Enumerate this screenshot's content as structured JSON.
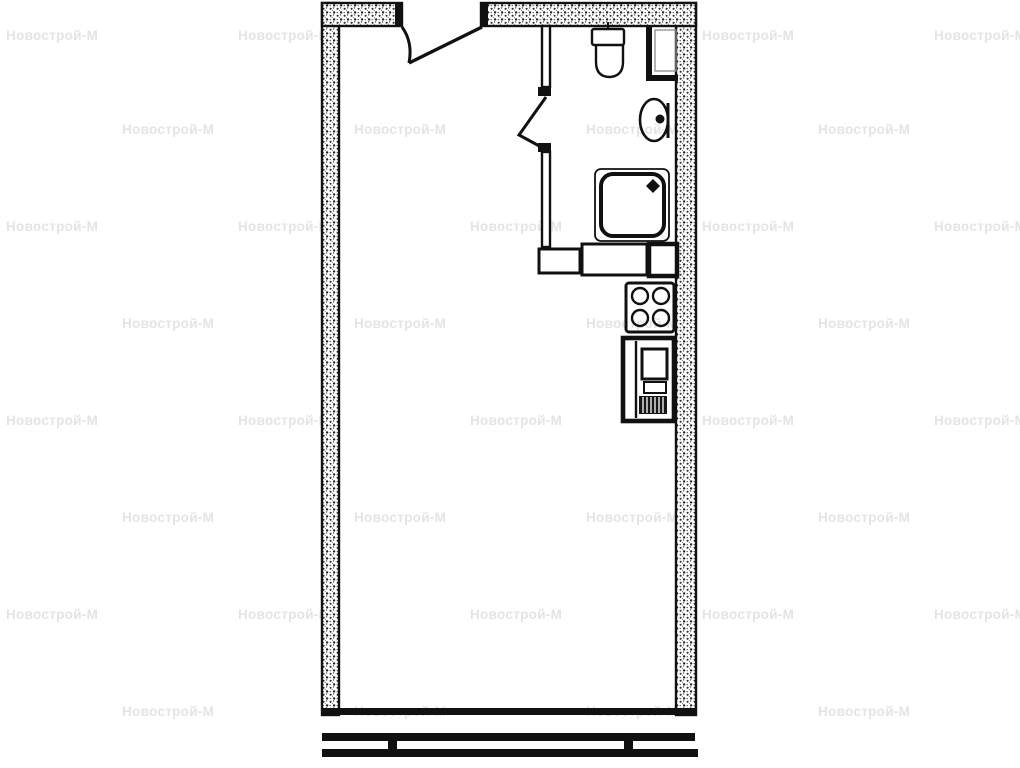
{
  "watermark": {
    "text": "Новострой-М",
    "color": "#e4e4e4"
  },
  "plan": {
    "kind": "studio-apartment-floor-plan",
    "background": "#ffffff",
    "colors": {
      "ink": "#111111",
      "wall_speckle": "#2b2b2b",
      "fill": "#ffffff"
    },
    "rooms": [
      {
        "name": "main-room"
      },
      {
        "name": "bathroom"
      },
      {
        "name": "kitchen-niche"
      }
    ],
    "fixtures": [
      {
        "name": "entrance-door",
        "type": "door-swing"
      },
      {
        "name": "bathroom-door",
        "type": "door-swing"
      },
      {
        "name": "toilet",
        "type": "wc-with-tank"
      },
      {
        "name": "washbasin",
        "type": "oval-basin-with-drain"
      },
      {
        "name": "ventilation-shaft",
        "type": "duct"
      },
      {
        "name": "shower-tray",
        "type": "square-tray-corner-drain"
      },
      {
        "name": "stove",
        "type": "four-burner-cooktop"
      },
      {
        "name": "kitchen-sink-unit",
        "type": "base-cabinet"
      },
      {
        "name": "panoramic-window",
        "type": "double-line-glazing-with-mullions"
      }
    ]
  }
}
